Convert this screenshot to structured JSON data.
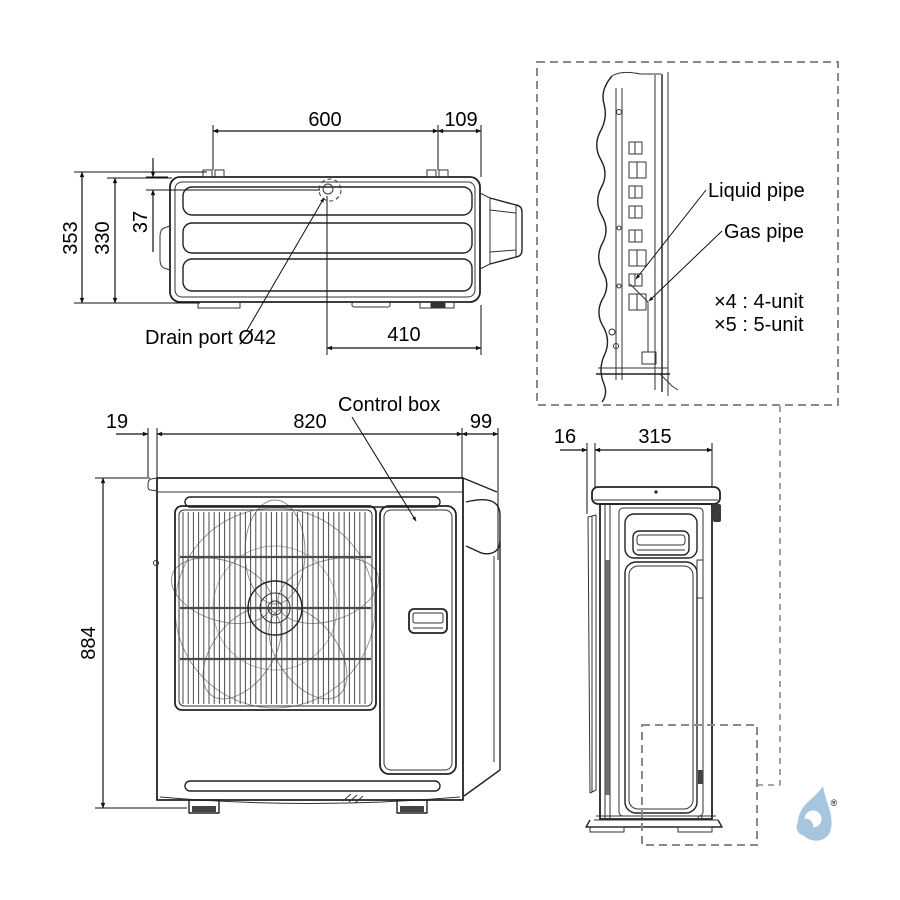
{
  "colors": {
    "line": "#222222",
    "dashed_gray": "#8a8a8a",
    "logo_blue": "#a6c5df",
    "background": "#ffffff"
  },
  "top_view": {
    "dim_top_width": "600",
    "dim_top_right": "109",
    "dim_height_outer": "353",
    "dim_height_inner": "330",
    "dim_drain_offset": "37",
    "dim_drain_from_right": "410",
    "drain_label": "Drain port Ø42"
  },
  "detail_view": {
    "liquid_pipe_label": "Liquid pipe",
    "gas_pipe_label": "Gas pipe",
    "note_line1": "×4 : 4-unit",
    "note_line2": "×5 : 5-unit"
  },
  "front_view": {
    "dim_left_offset": "19",
    "dim_width": "820",
    "dim_right_offset": "99",
    "dim_height": "884",
    "control_box_label": "Control box"
  },
  "side_view": {
    "dim_front_offset": "16",
    "dim_depth": "315"
  },
  "logo": {
    "registered_mark": "®"
  }
}
